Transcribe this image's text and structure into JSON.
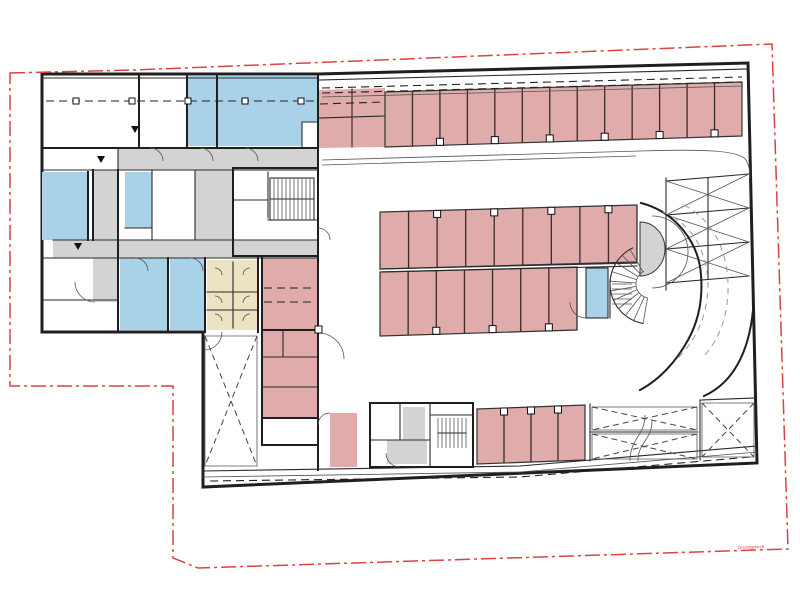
{
  "annotation": {
    "boundary_label": "Grundgrenze"
  },
  "colors": {
    "wall": "#1f1f1f",
    "room_blue": "#a9d2e8",
    "parking_pink": "#dfabab",
    "storage_beige": "#ece3c2",
    "corridor_gray": "#d3d3d3",
    "boundary_red": "#d8453e",
    "paper": "#ffffff"
  },
  "floor_plan": {
    "parking_groups": [
      {
        "id": "parking-row-top",
        "pts": [
          [
            385,
            92
          ],
          [
            742,
            82
          ],
          [
            742,
            136
          ],
          [
            385,
            147
          ]
        ],
        "stalls": 13,
        "col_side": "bottom",
        "col_every": 2
      },
      {
        "id": "parking-row-mid-upper",
        "pts": [
          [
            380,
            212
          ],
          [
            637,
            205
          ],
          [
            637,
            262
          ],
          [
            380,
            269
          ]
        ],
        "stalls": 9,
        "col_side": "top",
        "col_every": 2
      },
      {
        "id": "parking-row-mid-lower",
        "pts": [
          [
            380,
            272
          ],
          [
            577,
            267
          ],
          [
            577,
            330
          ],
          [
            380,
            336
          ]
        ],
        "stalls": 7,
        "col_side": "bottom",
        "col_every": 2
      },
      {
        "id": "parking-row-bottom",
        "pts": [
          [
            477,
            409
          ],
          [
            585,
            405
          ],
          [
            585,
            460
          ],
          [
            477,
            464
          ]
        ],
        "stalls": 4,
        "col_side": "top",
        "col_every": 1
      }
    ],
    "hatch_areas": [
      {
        "id": "void-cross-left",
        "pts": [
          [
            205,
            336
          ],
          [
            257,
            336
          ],
          [
            257,
            466
          ],
          [
            205,
            466
          ]
        ]
      },
      {
        "id": "ramp-room-upper",
        "pts": [
          [
            592,
            407
          ],
          [
            697,
            407
          ],
          [
            697,
            430
          ],
          [
            592,
            430
          ]
        ]
      },
      {
        "id": "ramp-room-lower",
        "pts": [
          [
            592,
            434
          ],
          [
            697,
            434
          ],
          [
            697,
            459
          ],
          [
            592,
            459
          ]
        ]
      },
      {
        "id": "ramp-room-right",
        "pts": [
          [
            702,
            403
          ],
          [
            754,
            403
          ],
          [
            754,
            457
          ],
          [
            702,
            457
          ]
        ]
      }
    ],
    "spiral_stair": {
      "cx": 650,
      "cy": 284,
      "r_inner": 14,
      "r_outer": 40,
      "a_start": 100,
      "a_end": 245,
      "step": 14
    }
  }
}
